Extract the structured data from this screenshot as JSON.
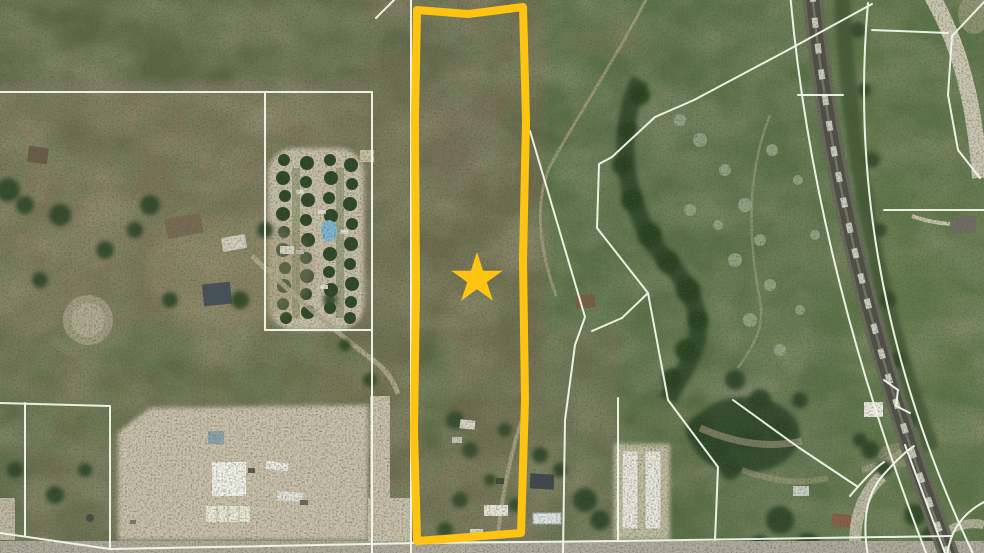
{
  "map": {
    "type": "satellite-aerial-parcel-map",
    "canvas": {
      "width": 984,
      "height": 553
    },
    "highlight_parcel": {
      "outline_color": "#FFC412",
      "outline_width": 8,
      "shape": "tall-narrow-rectangle"
    },
    "star_marker": {
      "color": "#FFC412",
      "points": 5
    },
    "parcel_lines": {
      "color": "#F2F8EA",
      "width": 2
    },
    "terrain_colors": {
      "scrub": "#6E7051",
      "green_field": "#5A7148",
      "creek_trees": "#2C4226",
      "sage_trees": "#96A689",
      "dirt_lot": "#CBC1AD",
      "road": "#B2AC9E",
      "railroad": "#4E4E46",
      "train": "#D7D6CC",
      "pond": "#82B7D8"
    },
    "features": [
      {
        "name": "highlighted-parcel"
      },
      {
        "name": "star-marker"
      },
      {
        "name": "rv-park"
      },
      {
        "name": "railroad"
      },
      {
        "name": "creek-corridor"
      },
      {
        "name": "dirt-lot"
      },
      {
        "name": "farmstead"
      },
      {
        "name": "barns"
      },
      {
        "name": "parcel-boundary-lines"
      },
      {
        "name": "bottom-road"
      }
    ]
  }
}
